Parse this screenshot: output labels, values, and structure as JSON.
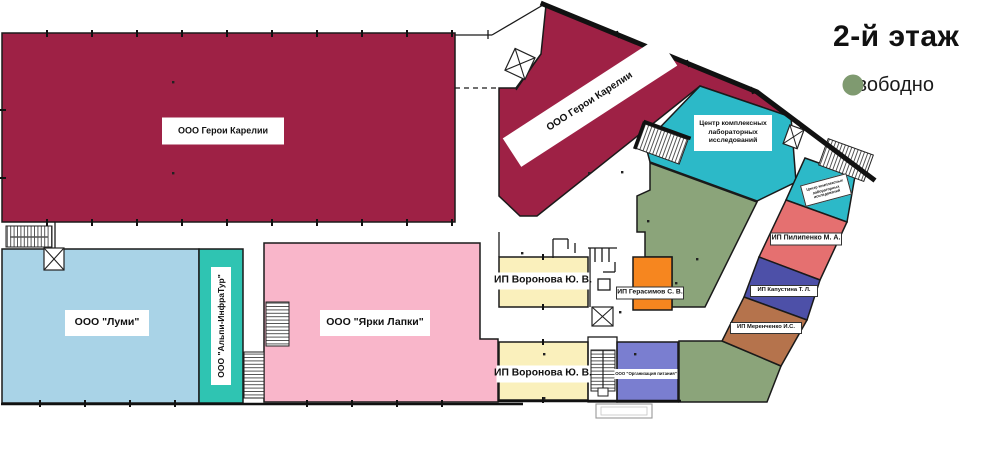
{
  "header": {
    "floor_number": "2",
    "floor_suffix": "-й этаж"
  },
  "legend": {
    "free": "Свободно"
  },
  "colors": {
    "maroon": "#9e2145",
    "cyan": "#2cb9c8",
    "teal": "#2fc4b2",
    "light_blue": "#a9d3e7",
    "pink": "#f9b6ca",
    "yellow": "#faf0bc",
    "orange": "#f6861f",
    "salmon": "#e57070",
    "indigo": "#4d50a8",
    "brown": "#b5734c",
    "periwinkle": "#7a7ed0",
    "sage": "#8ba47a",
    "sage_dot": "#7f9a70"
  },
  "rooms": {
    "geroi_main": {
      "label": "ООО Герои Карелии"
    },
    "geroi_wing": {
      "label": "ООО Герои Карелии"
    },
    "lab_center": {
      "label": "Центр комплексных лабораторных исследований"
    },
    "lab_center_small": {
      "label": "Центр комплексных лабораторных исследований"
    },
    "lumi": {
      "label": "ООО \"Луми\""
    },
    "alpi": {
      "label": "ООО \"Альпи-ИнфраТур\""
    },
    "yarki": {
      "label": "ООО \"Ярки Лапки\""
    },
    "voronova_top": {
      "label": "ИП Воронова Ю. В."
    },
    "voronova_bottom": {
      "label": "ИП Воронова Ю. В."
    },
    "gerasimov": {
      "label": "ИП Герасимов С. В."
    },
    "pilipenko": {
      "label": "ИП Пилипенко М. А."
    },
    "kapustina": {
      "label": "ИП Капустина Т. Л."
    },
    "merenchenko": {
      "label": "ИП Меренченко И.С."
    },
    "pitanie": {
      "label": "ООО \"Организация питания\""
    }
  }
}
